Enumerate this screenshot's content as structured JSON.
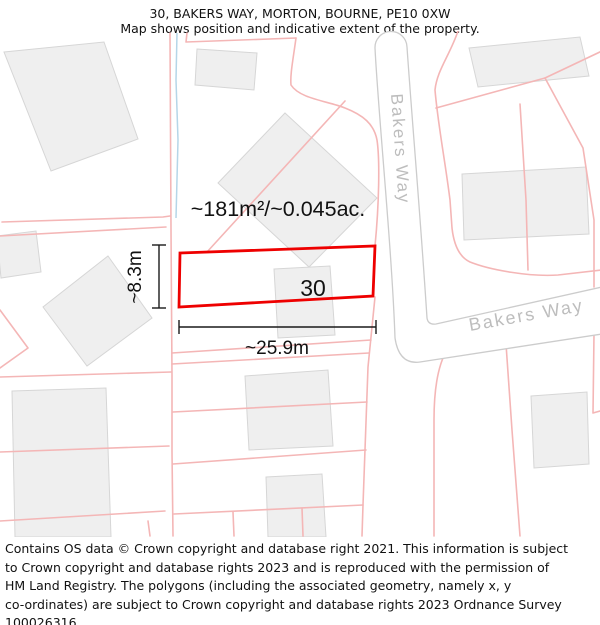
{
  "title": {
    "line1": "30, BAKERS WAY, MORTON, BOURNE, PE10 0XW",
    "line2": "Map shows position and indicative extent of the property."
  },
  "map": {
    "plot": {
      "number": "30",
      "area_label": "~181m²/~0.045ac.",
      "width_label": "~25.9m",
      "depth_label": "~8.3m"
    },
    "roads": {
      "vertical_label": "Bakers Way",
      "horizontal_label": "Bakers Way"
    },
    "colors": {
      "plot_outline": "#ee0000",
      "parcel_line": "#f4b6b6",
      "building_fill": "#efefef",
      "building_stroke": "#d6d6d6",
      "road_border": "#cccccc",
      "road_label": "#bdbdbd",
      "water_line": "#b5d6e8",
      "dimension_line": "#1a1a1a"
    }
  },
  "footer": {
    "lines": [
      "Contains OS data © Crown copyright and database right 2021. This information is subject",
      "to Crown copyright and database rights 2023 and is reproduced with the permission of",
      "HM Land Registry. The polygons (including the associated geometry, namely x, y",
      "co-ordinates) are subject to Crown copyright and database rights 2023 Ordnance Survey",
      "100026316."
    ]
  }
}
